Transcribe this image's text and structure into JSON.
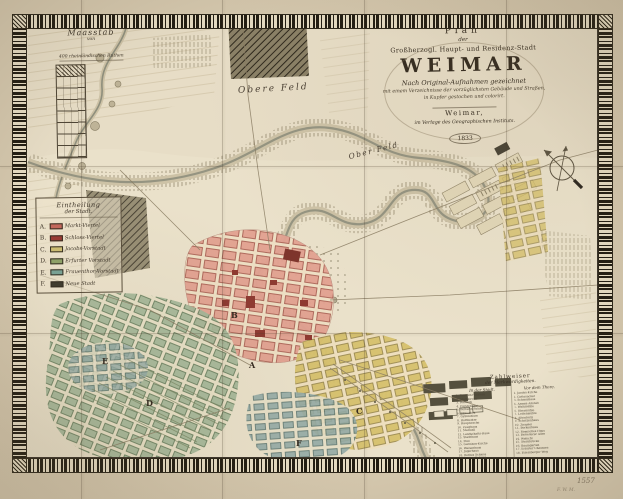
{
  "cartouche": {
    "line1": "Plan",
    "line2": "der",
    "line3": "Großherzogl. Haupt- und Residenz-Stadt",
    "title": "WEIMAR",
    "line5": "Nach Original-Aufnahmen gezeichnet",
    "line6": "mit einem Verzeichnisse der vorzüglichsten Gebäude und Straßen,",
    "line7": "in Kupfer gestochen und colorirt.",
    "line8": "Weimar,",
    "line9": "im Verlage des Geographischen Instituts.",
    "year": "1833"
  },
  "scale": {
    "title": "Maasstab",
    "sub": "von",
    "unit": "400 rheinländischen Ruthen"
  },
  "legend": {
    "title_line1": "Eintheilung",
    "title_line2": "der Stadt.",
    "items": [
      {
        "letter": "A.",
        "label": "Markt-Viertel",
        "color": "#c4685c"
      },
      {
        "letter": "B.",
        "label": "Schloss-Viertel",
        "color": "#993a33"
      },
      {
        "letter": "C.",
        "label": "Jacobs-Vorstadt",
        "color": "#cdbd72"
      },
      {
        "letter": "D.",
        "label": "Erfurter Vorstadt",
        "color": "#8fa368"
      },
      {
        "letter": "E.",
        "label": "Frauenthor-Vorstadt",
        "color": "#79a396"
      },
      {
        "letter": "F.",
        "label": "Neue Stadt",
        "color": "#3e3a2e"
      }
    ]
  },
  "index": {
    "title_line1": "Zahlweiser",
    "title_line2": "der Merkwürdigkeiten.",
    "left": {
      "header": "In der Stadt.",
      "entries": [
        "1. Residenz-Schloss",
        "2. Stadtkirche",
        "3. Rathaus",
        "4. Fürstenhaus",
        "5. Wittums-Palais",
        "6. Bibliothek",
        "7. Gymnasium",
        "8. Hoftheater",
        "9. Hauptwache",
        "10. Zeughaus",
        "11. Marstall",
        "12. Landschafts-Haus",
        "13. Stadthaus",
        "14. Post",
        "15. Garnison-Kirche",
        "16. Waisenhaus",
        "17. Jägerhaus",
        "18. Rothes Schloss",
        "19. Gelbes Schloss",
        "20. Freimaurer-Loge"
      ]
    },
    "right": {
      "header": "Vor dem Thore.",
      "entries": [
        "1. Jacobs-Kirche",
        "2. Gottesacker",
        "3. Schiesshaus",
        "4. Armen-Anstalt",
        "5. Walkmühle",
        "6. Obermühle",
        "7. Lottenmühle",
        "8. Altenburg",
        "9. Schützenhaus",
        "10. Ziegelei",
        "11. Borkenhaus",
        "12. Römisches Haus",
        "13. Belvederer Allee",
        "14. Webicht",
        "15. Sternbrücke",
        "16. Baumgarten",
        "17. Erfurter Chaussee",
        "18. Ettersburger Weg"
      ]
    }
  },
  "map_labels": {
    "field_upper": "Obere Feld",
    "field_right": "Ober Feld"
  },
  "quarter_letters": {
    "a": "A",
    "b": "B",
    "c": "C",
    "d": "D",
    "e": "E",
    "f": "F"
  },
  "annotations": {
    "pencil_number": "1557",
    "pencil_note": "F. W. M."
  },
  "palette": {
    "paper_margin": "#d5c8ae",
    "paper_map": "#eae1ca",
    "border_ink": "#211c12",
    "river": "#8f8f7d",
    "woods": "#2e281c"
  }
}
